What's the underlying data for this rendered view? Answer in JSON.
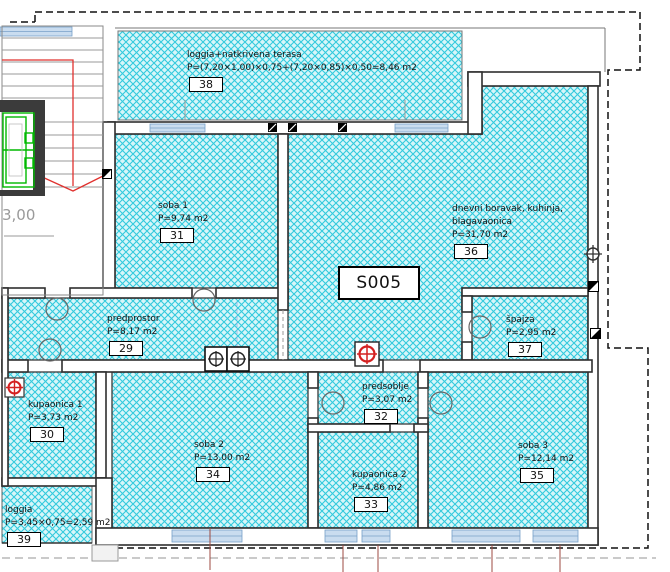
{
  "plan": {
    "unit_label": "S005",
    "left_dimension": "3,00",
    "rooms": [
      {
        "number": "38",
        "name": "loggia+natkrivena terasa",
        "area": "P=(7,20×1,00)×0,75+(7,20×0,85)×0,50=8,46 m2"
      },
      {
        "number": "31",
        "name": "soba 1",
        "area": "P=9,74 m2"
      },
      {
        "number": "36",
        "name": "dnevni boravak, kuhinja,\nblagavaonica",
        "area": "P=31,70 m2"
      },
      {
        "number": "29",
        "name": "predprostor",
        "area": "P=8,17 m2"
      },
      {
        "number": "37",
        "name": "špajza",
        "area": "P=2,95 m2"
      },
      {
        "number": "30",
        "name": "kupaonica 1",
        "area": "P=3,73 m2"
      },
      {
        "number": "32",
        "name": "predsoblje",
        "area": "P=3,07 m2"
      },
      {
        "number": "34",
        "name": "soba 2",
        "area": "P=13,00 m2"
      },
      {
        "number": "33",
        "name": "kupaonica 2",
        "area": "P=4,86 m2"
      },
      {
        "number": "35",
        "name": "soba 3",
        "area": "P=12,14 m2"
      },
      {
        "number": "39",
        "name": "loggia",
        "area": "P=3,45×0,75=2,59 m2"
      }
    ],
    "colors": {
      "hatch_fill": "#d7f6f9",
      "hatch_line": "#32cadd",
      "wall": "#383838",
      "window_blue": "#c9dcef",
      "elevator_green": "#00b800",
      "stair_red": "#e0312e",
      "marker_red": "#d42020",
      "dimension_grey": "#9a9a9a"
    }
  }
}
